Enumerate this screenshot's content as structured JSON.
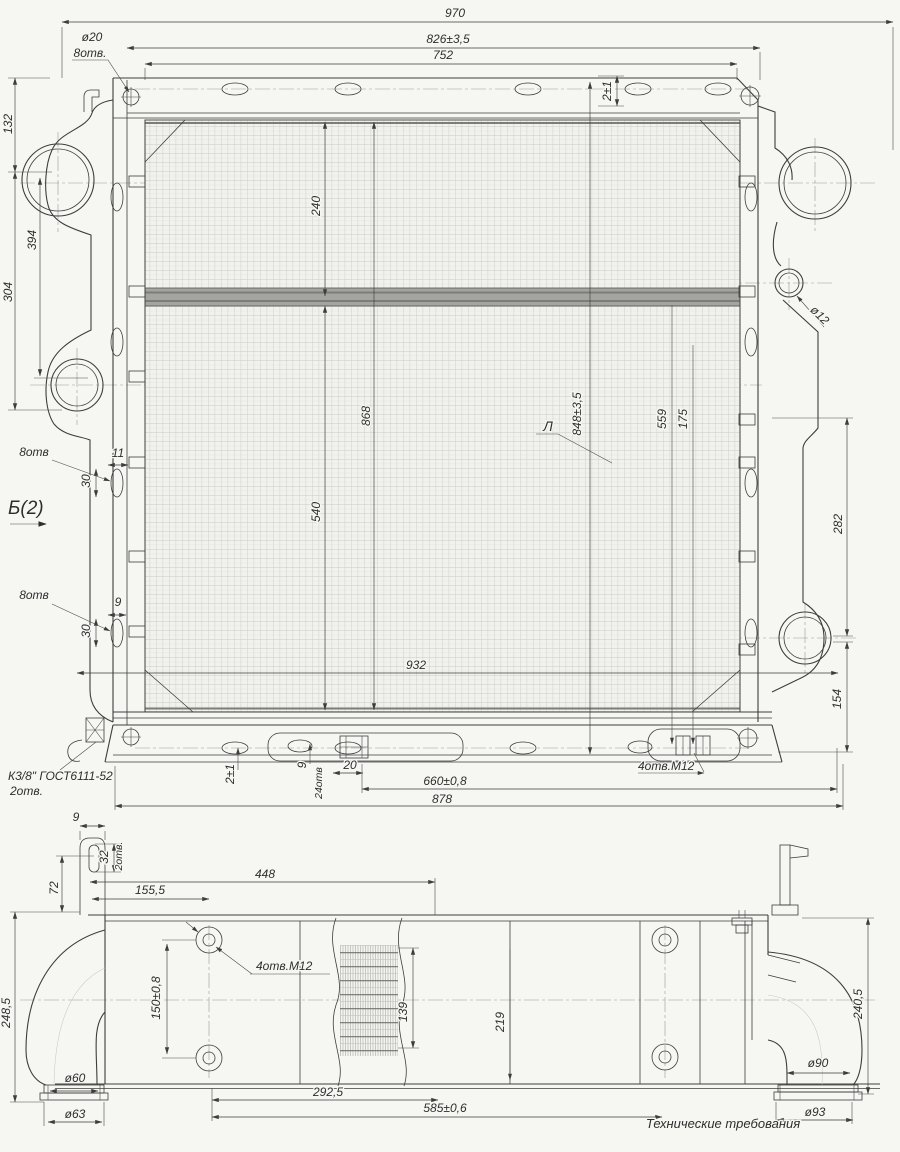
{
  "drawing_title": "Радиатор — габаритный чертёж",
  "colors": {
    "line": "#3d3d3d",
    "light_line": "#c9c9c5",
    "core_band": "#9b9b97",
    "background": "#f6f6f3"
  },
  "front_view": {
    "top": {
      "overall_width": "970",
      "mount_width": "826±3,5",
      "inner_width": "752",
      "hole_dia": "ø20",
      "hole_count": "8отв.",
      "edge_gap": "2±1"
    },
    "left": {
      "h132": "132",
      "h394": "394",
      "h304": "304",
      "view_label": "Б(2)",
      "upper_holes": {
        "count": "8отв",
        "width": "11",
        "height": "30"
      },
      "lower_holes": {
        "count": "8отв",
        "width": "9",
        "height": "30"
      }
    },
    "core": {
      "h240": "240",
      "h868": "868",
      "h540": "540",
      "h848": "848±3,5",
      "h559": "559",
      "h175": "175",
      "detail_label": "Л"
    },
    "right": {
      "dia12": "ø12",
      "h282": "282",
      "h154": "154"
    },
    "bottom": {
      "w932": "932",
      "fitting": "К3/8\" ГОСТ6111-52",
      "fitting_holes": "2отв.",
      "gap": "2±1",
      "w9": "9",
      "holes24": "24отв",
      "w20": "20",
      "w660": "660±0,8",
      "w878": "878",
      "bolt_holes": "4отв.М12"
    }
  },
  "side_view": {
    "top": {
      "t9": "9",
      "slot32": "32",
      "slot_holes": "2отв.",
      "h72": "72",
      "w155": "155,5",
      "w448": "448"
    },
    "middle": {
      "bolt_holes": "4отв.М12",
      "h150": "150±0,8",
      "h139": "139",
      "h219": "219"
    },
    "left": {
      "h248": "248,5",
      "dia60": "ø60",
      "dia63": "ø63"
    },
    "right": {
      "h240": "240,5",
      "dia90": "ø90",
      "dia93": "ø93"
    },
    "bottom": {
      "w292": "292,5",
      "w585": "585±0,6",
      "note": "Технические требования"
    }
  }
}
